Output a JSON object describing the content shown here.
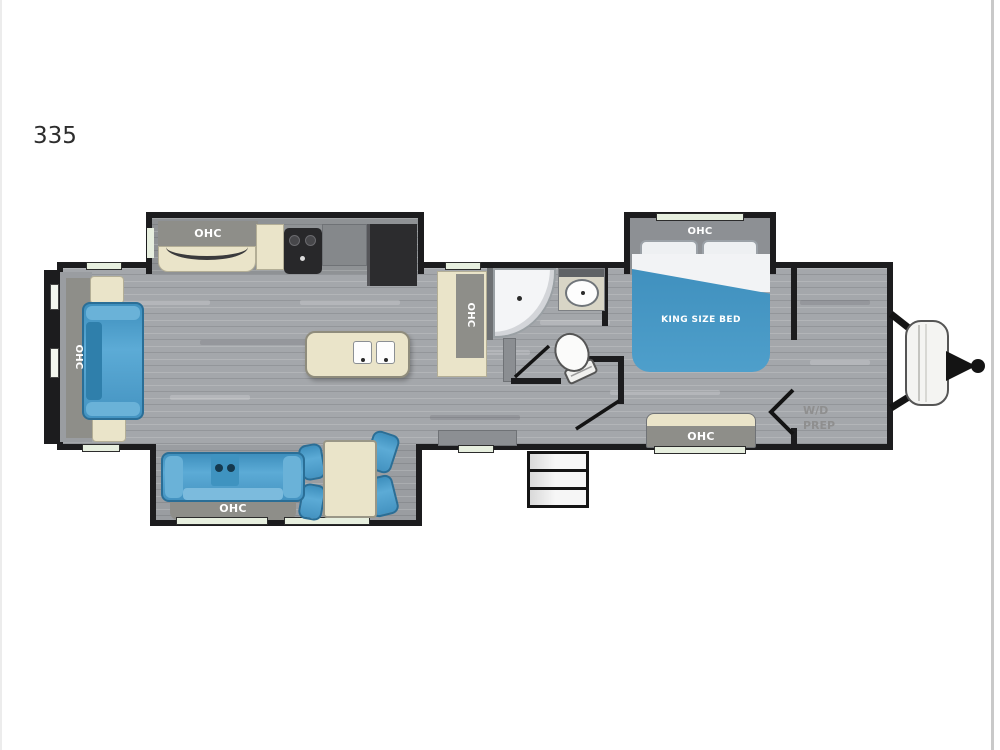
{
  "page": {
    "model_number": "335"
  },
  "colors": {
    "wall": "#1c1c1e",
    "floor_gray": "#a4a7ab",
    "slide_floor_gray": "#9a9da1",
    "furniture_blue": "#4a9fcb",
    "furniture_blue_dark": "#2a6e96",
    "cream_cabinet": "#eae4c9",
    "gray_cabinet": "#8e8e89",
    "window_glass": "#e7efdf",
    "appliance_dark": "#2b2b2d",
    "label_text": "#ffffff",
    "wd_text": "#8f8f8f"
  },
  "floorplan": {
    "rear_living": {
      "sofa_ohc": "OHC"
    },
    "kitchen": {
      "ohc": "OHC"
    },
    "bathroom": {
      "ohc": "OHC"
    },
    "bedroom": {
      "overhead_cabinet": "OHC",
      "bed_label": "KING SIZE BED",
      "rear_wall_cabinet": "OHC"
    },
    "front_storage": {
      "wd_prep": [
        "W/D",
        "PREP"
      ]
    },
    "dinette_slide": {
      "sofa_ohc": "OHC"
    }
  }
}
